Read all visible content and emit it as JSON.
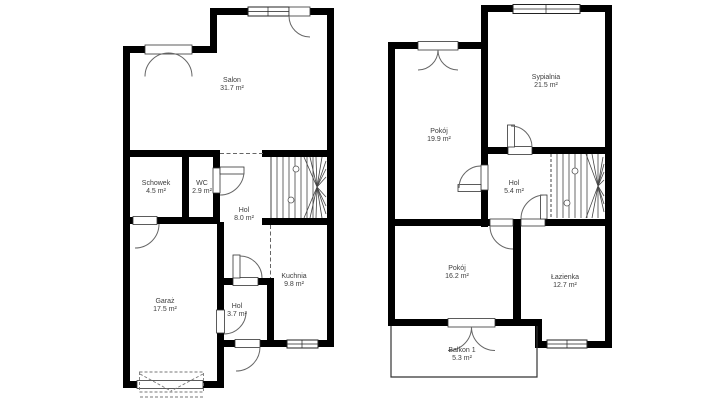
{
  "colors": {
    "wall": "#000000",
    "background": "#ffffff",
    "label_text": "#3d3d3d",
    "thin_line": "#666666"
  },
  "plans": {
    "ground_floor": {
      "rooms": [
        {
          "name": "Salon",
          "area": "31.7 m²"
        },
        {
          "name": "Schowek",
          "area": "4.5 m²"
        },
        {
          "name": "WC",
          "area": "2.9 m²"
        },
        {
          "name": "Hol",
          "area": "8.0 m²"
        },
        {
          "name": "Garaż",
          "area": "17.5 m²"
        },
        {
          "name": "Hol",
          "area": "3.7 m²"
        },
        {
          "name": "Kuchnia",
          "area": "9.8 m²"
        }
      ]
    },
    "upper_floor": {
      "rooms": [
        {
          "name": "Pokój",
          "area": "19.9 m²"
        },
        {
          "name": "Sypialnia",
          "area": "21.5 m²"
        },
        {
          "name": "Hol",
          "area": "5.4 m²"
        },
        {
          "name": "Pokój",
          "area": "16.2 m²"
        },
        {
          "name": "Łazienka",
          "area": "12.7 m²"
        },
        {
          "name": "Balkon 1",
          "area": "5.3 m²"
        }
      ]
    }
  }
}
